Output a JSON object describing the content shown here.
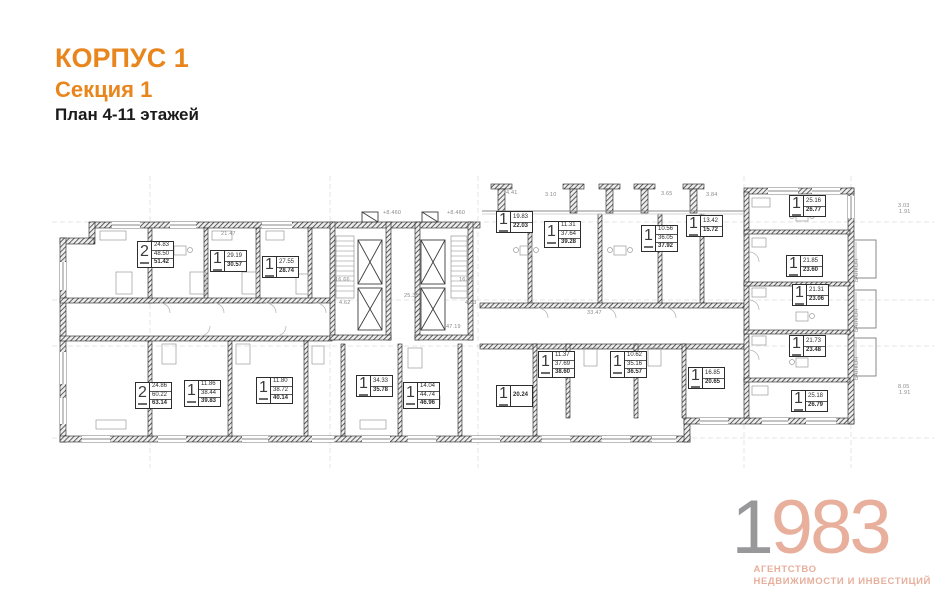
{
  "header": {
    "building": "КОРПУС 1",
    "section": "Секция 1",
    "plan_title": "План 4-11 этажей"
  },
  "logo": {
    "year_first": "1",
    "year_rest": "983",
    "agency_line1": "АГЕНТСТВО",
    "agency_line2": "НЕДВИЖИМОСТИ И ИНВЕСТИЦИЙ"
  },
  "colors": {
    "accent_orange": "#E8861D",
    "logo_gray": "#98989A",
    "logo_salmon": "#E7AF9C"
  },
  "plan": {
    "apartments": [
      {
        "rooms": "2",
        "areas": [
          "24.83",
          "48.50",
          "51.42"
        ],
        "x": 137,
        "y": 241
      },
      {
        "rooms": "1",
        "areas": [
          "29.19",
          "30.57"
        ],
        "x": 210,
        "y": 250
      },
      {
        "rooms": "1",
        "areas": [
          "27.55",
          "28.74"
        ],
        "x": 262,
        "y": 256
      },
      {
        "rooms": "1",
        "areas": [
          "19.83",
          "22.03"
        ],
        "x": 496,
        "y": 211
      },
      {
        "rooms": "1",
        "areas": [
          "11.31",
          "37.64",
          "39.28"
        ],
        "x": 544,
        "y": 221
      },
      {
        "rooms": "1",
        "areas": [
          "10.56",
          "36.05",
          "37.92"
        ],
        "x": 641,
        "y": 225
      },
      {
        "rooms": "1",
        "areas": [
          "13.42",
          "15.72"
        ],
        "x": 686,
        "y": 215
      },
      {
        "rooms": "1",
        "areas": [
          "25.16",
          "26.77"
        ],
        "x": 789,
        "y": 195
      },
      {
        "rooms": "1",
        "areas": [
          "21.85",
          "23.60"
        ],
        "x": 786,
        "y": 255
      },
      {
        "rooms": "1",
        "areas": [
          "21.31",
          "23.06"
        ],
        "x": 792,
        "y": 284
      },
      {
        "rooms": "1",
        "areas": [
          "21.73",
          "23.48"
        ],
        "x": 789,
        "y": 335
      },
      {
        "rooms": "1",
        "areas": [
          "25.18",
          "26.79"
        ],
        "x": 791,
        "y": 390
      },
      {
        "rooms": "2",
        "areas": [
          "24.86",
          "60.22",
          "63.14"
        ],
        "x": 135,
        "y": 382
      },
      {
        "rooms": "1",
        "areas": [
          "11.86",
          "38.44",
          "39.83"
        ],
        "x": 184,
        "y": 380
      },
      {
        "rooms": "1",
        "areas": [
          "11.80",
          "38.72",
          "40.14"
        ],
        "x": 256,
        "y": 377
      },
      {
        "rooms": "1",
        "areas": [
          "34.33",
          "35.78"
        ],
        "x": 356,
        "y": 375
      },
      {
        "rooms": "1",
        "areas": [
          "14.04",
          "44.74",
          "46.96"
        ],
        "x": 403,
        "y": 382
      },
      {
        "rooms": "1",
        "areas": [
          "20.24"
        ],
        "x": 496,
        "y": 385
      },
      {
        "rooms": "1",
        "areas": [
          "11.37",
          "37.69",
          "38.60"
        ],
        "x": 538,
        "y": 351
      },
      {
        "rooms": "1",
        "areas": [
          "10.62",
          "35.16",
          "36.57"
        ],
        "x": 610,
        "y": 351
      },
      {
        "rooms": "1",
        "areas": [
          "16.85",
          "20.65"
        ],
        "x": 688,
        "y": 367
      }
    ],
    "annotations": [
      {
        "text": "16.66",
        "x": 335,
        "y": 277
      },
      {
        "text": "16.66",
        "x": 459,
        "y": 277
      },
      {
        "text": "25.35",
        "x": 404,
        "y": 293
      },
      {
        "text": "4.62",
        "x": 339,
        "y": 300
      },
      {
        "text": "4.63",
        "x": 465,
        "y": 300
      },
      {
        "text": "47.19",
        "x": 446,
        "y": 324
      },
      {
        "text": "33.47",
        "x": 587,
        "y": 310
      },
      {
        "text": "+8.460",
        "x": 383,
        "y": 210
      },
      {
        "text": "+8.460",
        "x": 447,
        "y": 210
      },
      {
        "text": "4.41",
        "x": 506,
        "y": 190
      },
      {
        "text": "3.10",
        "x": 545,
        "y": 192
      },
      {
        "text": "3.65",
        "x": 661,
        "y": 191
      },
      {
        "text": "3.84",
        "x": 706,
        "y": 192
      },
      {
        "text": "21.47",
        "x": 221,
        "y": 231
      },
      {
        "text": "3.03",
        "x": 898,
        "y": 203
      },
      {
        "text": "1.91",
        "x": 899,
        "y": 209
      },
      {
        "text": "8.05",
        "x": 898,
        "y": 384
      },
      {
        "text": "1.91",
        "x": 899,
        "y": 390
      },
      {
        "text": "БАЛКОН",
        "x": 860,
        "y": 276,
        "vertical": true
      },
      {
        "text": "БАЛКОН",
        "x": 860,
        "y": 326,
        "vertical": true
      },
      {
        "text": "БАЛКОН",
        "x": 860,
        "y": 374,
        "vertical": true
      }
    ]
  }
}
